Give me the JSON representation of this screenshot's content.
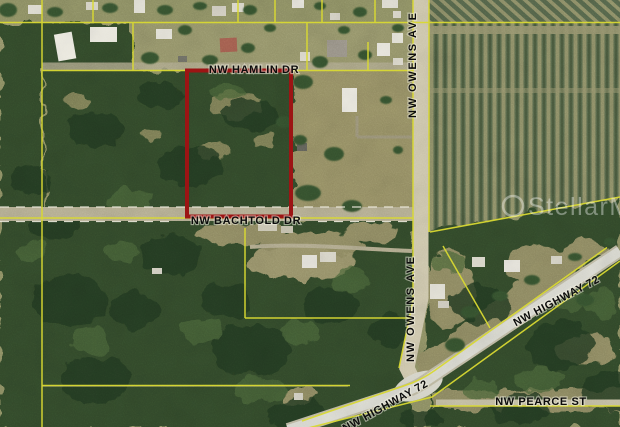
{
  "map": {
    "road_labels": {
      "hamlin": "NW HAMLIN DR",
      "bachtold": "NW BACHTOLD DR",
      "owens_north": "NW OWENS AVE",
      "owens_south": "NW OWENS AVE",
      "highway72_east": "NW HIGHWAY 72",
      "highway72_southwest": "NW HIGHWAY 72",
      "pearce": "NW PEARCE ST"
    },
    "watermark": "StellarMLS",
    "colors": {
      "parcel_boundary": "#d9d932",
      "subject_parcel": "#9c1414",
      "label_text": "#0c0c0c",
      "road_dash": "#edeadd",
      "watermark_text": "#ffffff"
    }
  }
}
